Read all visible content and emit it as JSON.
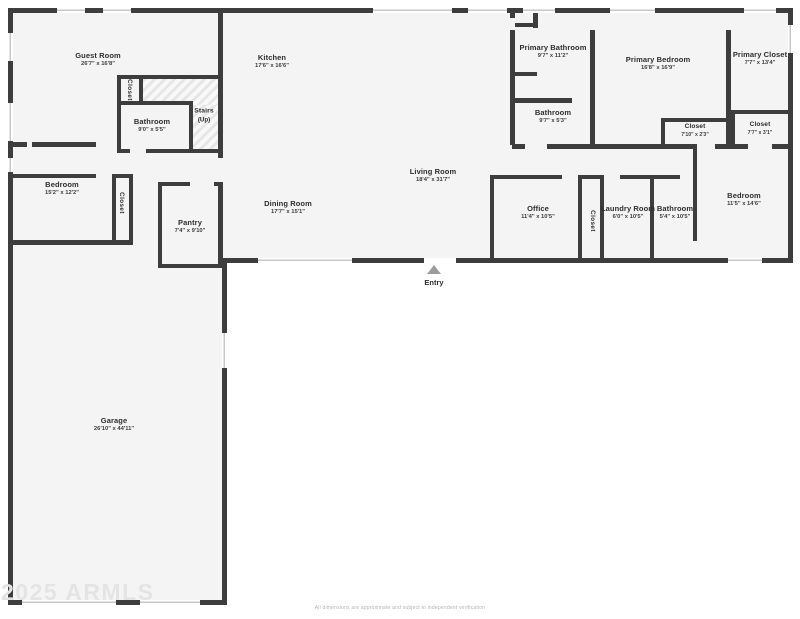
{
  "watermark": "2025 ARMLS",
  "disclaimer": "All dimensions are approximate and subject to independent verification",
  "entry": {
    "label": "Entry"
  },
  "colors": {
    "wall": "#3d3d3d",
    "floor": "#f3f4f3",
    "background": "#ffffff",
    "marker": "#9c9c9c"
  },
  "rooms": {
    "guest_room": {
      "name": "Guest Room",
      "dims": "26'7\" x 16'8\""
    },
    "guest_closet": {
      "name": "Closet",
      "dims": ""
    },
    "guest_bathroom": {
      "name": "Bathroom",
      "dims": "9'0\" x 5'5\""
    },
    "stairs": {
      "name": "Stairs",
      "dims": "(Up)"
    },
    "kitchen": {
      "name": "Kitchen",
      "dims": "17'6\" x 16'6\""
    },
    "primary_bathroom": {
      "name": "Primary Bathroom",
      "dims": "9'7\" x 11'2\""
    },
    "primary_bedroom": {
      "name": "Primary Bedroom",
      "dims": "16'8\" x 16'9\""
    },
    "primary_closet": {
      "name": "Primary Closet",
      "dims": "7'7\" x 13'4\""
    },
    "upper_bathroom": {
      "name": "Bathroom",
      "dims": "9'7\" x 5'3\""
    },
    "closet_a": {
      "name": "Closet",
      "dims": "7'10\" x 2'3\""
    },
    "closet_b": {
      "name": "Closet",
      "dims": "7'7\" x 3'1\""
    },
    "left_bedroom": {
      "name": "Bedroom",
      "dims": "15'2\" x 12'2\""
    },
    "left_bedroom_closet": {
      "name": "Closet",
      "dims": ""
    },
    "pantry": {
      "name": "Pantry",
      "dims": "7'4\" x 9'10\""
    },
    "dining_room": {
      "name": "Dining Room",
      "dims": "17'7\" x 15'1\""
    },
    "living_room": {
      "name": "Living Room",
      "dims": "18'4\" x 31'7\""
    },
    "office": {
      "name": "Office",
      "dims": "11'4\" x 10'5\""
    },
    "hall_closet": {
      "name": "Closet",
      "dims": ""
    },
    "laundry_room": {
      "name": "Laundry Room",
      "dims": "6'0\" x 10'5\""
    },
    "hall_bathroom": {
      "name": "Bathroom",
      "dims": "5'4\" x 10'5\""
    },
    "right_bedroom": {
      "name": "Bedroom",
      "dims": "11'5\" x 14'6\""
    },
    "garage": {
      "name": "Garage",
      "dims": "26'10\" x 44'11\""
    }
  }
}
